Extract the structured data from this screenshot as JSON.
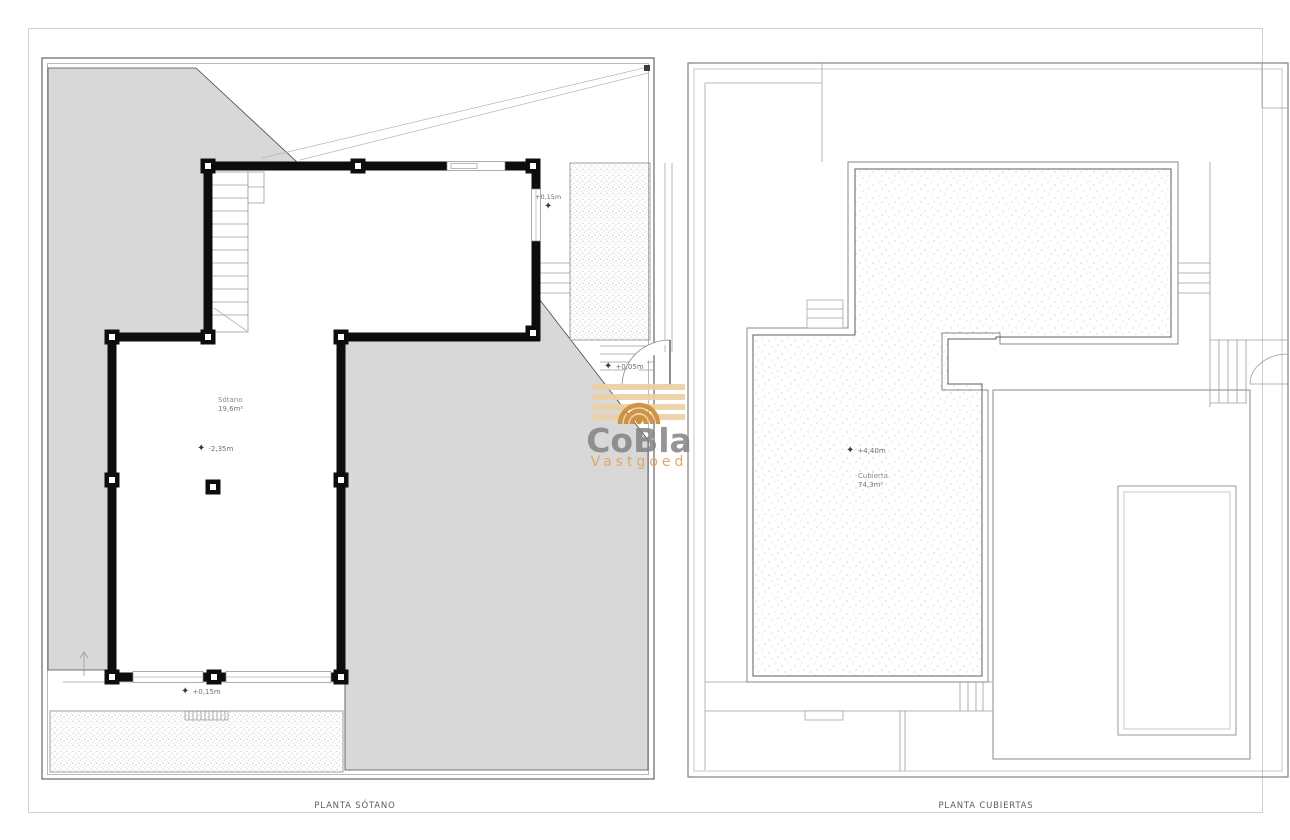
{
  "icons": {
    "elevation_star": "✦"
  },
  "watermark": {
    "brand": "CoBla",
    "subtitle": "Vastgoed"
  },
  "plans": {
    "basement": {
      "caption": "PLANTA SÓTANO",
      "room": {
        "name": "Sótano",
        "area": "19,6m²"
      },
      "markers": {
        "top_right": "+0,15m",
        "entry": "+0,05m",
        "room": "-2,35m",
        "bottom": "+0,15m"
      }
    },
    "roof": {
      "caption": "PLANTA CUBIERTAS",
      "room": {
        "name": "Cubierta",
        "area": "74,3m²"
      },
      "markers": {
        "level": "+4,40m"
      }
    }
  },
  "colors": {
    "terrain_gray": "#d8d8d8",
    "wall_black": "#0d0d0d",
    "brand_gray": "#8a8a8a",
    "accent_orange": "#e0a866"
  }
}
